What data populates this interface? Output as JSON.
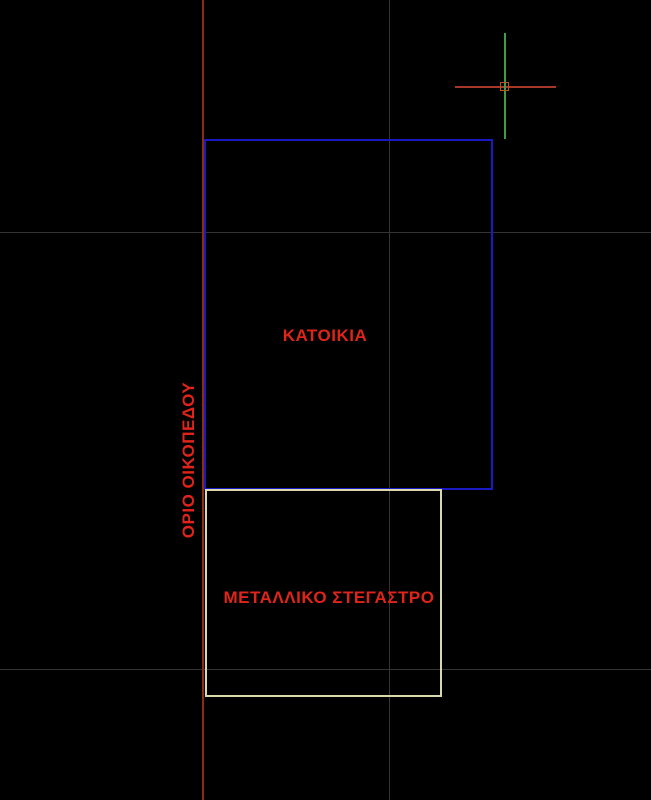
{
  "app": {
    "kind": "cad-drawing-viewport",
    "background": "#000000"
  },
  "drawing": {
    "labels": {
      "house": "ΚΑΤΟΙΚΙΑ",
      "canopy": "ΜΕΤΑΛΛΙΚΟ ΣΤΕΓΑΣΤΡΟ",
      "plot_boundary": "ΟΡΙΟ ΟΙΚΟΠΕΔΟΥ"
    },
    "colors": {
      "label_text": "#e0241a",
      "boundary_line": "#8c2d12",
      "house_outline": "#1a1ac4",
      "canopy_outline": "#d9d9ad",
      "grid_line": "#343434",
      "crosshair_horizontal": "#a8372b",
      "crosshair_vertical": "#3f9e42",
      "pickbox": "#b5521f"
    }
  }
}
